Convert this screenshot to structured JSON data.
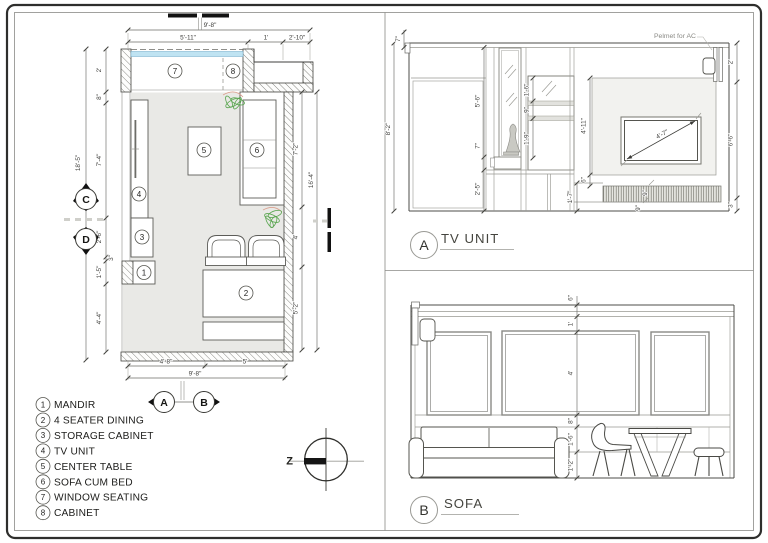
{
  "floor_plan": {
    "dims": {
      "top_overall": "9'-8\"",
      "top_1": "5'-11\"",
      "top_2": "1'",
      "top_3": "2'-10\"",
      "left_overall": "18'-5\"",
      "left_1": "2'",
      "left_2": "8\"",
      "left_3": "7'-4\"",
      "left_4": "2'-6\"",
      "left_5": "3\"",
      "left_6": "1'-5\"",
      "left_7": "4'-4\"",
      "right_overall": "16'-4\"",
      "right_1": "7'-2\"",
      "right_2": "4'",
      "right_3": "5'-2\"",
      "bottom_overall": "9'-8\"",
      "bottom_1": "4'-8\"",
      "bottom_2": "5'"
    },
    "callouts": {
      "c1": "1",
      "c2": "2",
      "c3": "3",
      "c4": "4",
      "c5": "5",
      "c6": "6",
      "c7": "7",
      "c8": "8"
    },
    "markers": {
      "a": "A",
      "b": "B",
      "c": "C",
      "d": "D"
    }
  },
  "legend": {
    "items": [
      {
        "num": "1",
        "label": "MANDIR"
      },
      {
        "num": "2",
        "label": "4 SEATER DINING"
      },
      {
        "num": "3",
        "label": "STORAGE CABINET"
      },
      {
        "num": "4",
        "label": "TV UNIT"
      },
      {
        "num": "5",
        "label": "CENTER TABLE"
      },
      {
        "num": "6",
        "label": "SOFA CUM BED"
      },
      {
        "num": "7",
        "label": "WINDOW SEATING"
      },
      {
        "num": "8",
        "label": "CABINET"
      }
    ]
  },
  "north": {
    "label": "Z"
  },
  "tv_unit": {
    "marker": "A",
    "title": "TV UNIT",
    "pelmet_note": "Pelmet for AC",
    "dims": {
      "overall_height": "8'-2\"",
      "top": "7\"",
      "mirror": "5'-6\"",
      "ledge": "7\"",
      "base": "2'-5\"",
      "shelf_1": "1'-6\"",
      "shelf_2": "9\"",
      "shelf_3": "1'-9\"",
      "panel": "4'-11\"",
      "tv_diagonal": "4'-7\"",
      "right_top": "2'",
      "right_mid": "6'-6\"",
      "right_bottom": "3\"",
      "gap": "6\"",
      "plinth": "1'-7\"",
      "drawer_a": "9\"",
      "drawer_b": "9\""
    }
  },
  "sofa": {
    "marker": "B",
    "title": "SOFA",
    "dims": {
      "cornice": "6\"",
      "frieze": "1'",
      "panel": "4'",
      "dado": "8\"",
      "backrest": "1'-6\"",
      "seat": "1'-2\""
    }
  },
  "colors": {
    "window": "#bfe3f2",
    "floor": "#e9e9e6",
    "plant": "#58a54e",
    "accent_dash": "#cfcfca"
  }
}
